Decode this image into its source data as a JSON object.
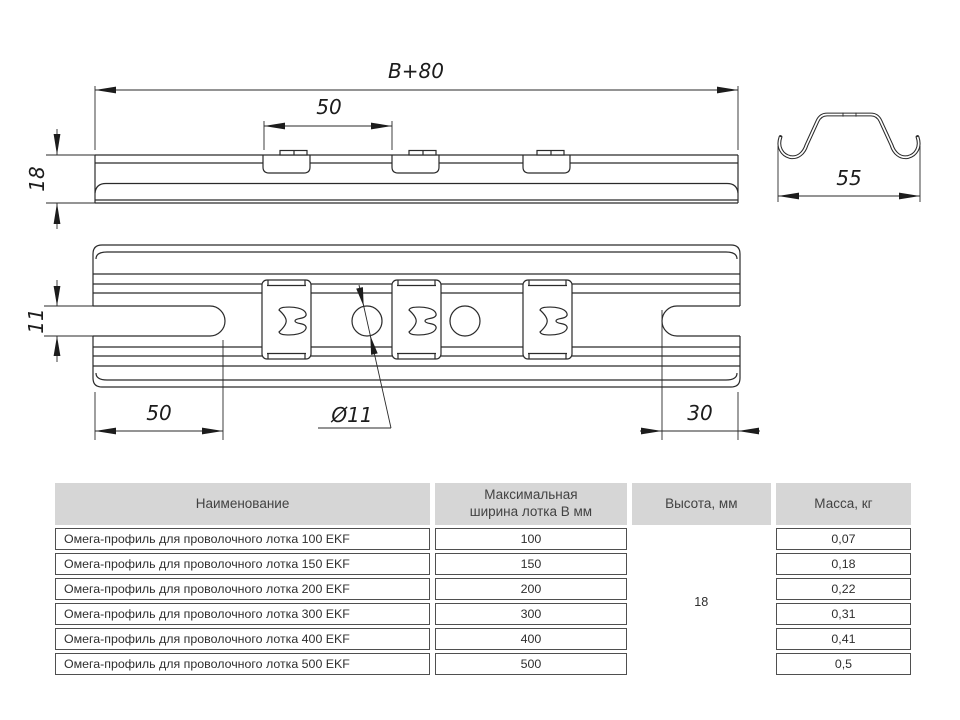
{
  "drawing": {
    "dim_b80": "В+80",
    "dim_50_top": "50",
    "dim_18": "18",
    "dim_55": "55",
    "dim_11": "11",
    "dim_50_bottom": "50",
    "dim_d11": "Ø11",
    "dim_30": "30"
  },
  "table": {
    "headers": {
      "name": "Наименование",
      "width_line1": "Максимальная",
      "width_line2": "ширина лотка В мм",
      "height": "Высота, мм",
      "mass": "Масса, кг"
    },
    "merged_height_value": "18",
    "rows": [
      {
        "name": "Омега-профиль для проволочного лотка 100 EKF",
        "width": "100",
        "mass": "0,07"
      },
      {
        "name": "Омега-профиль для проволочного лотка 150 EKF",
        "width": "150",
        "mass": "0,18"
      },
      {
        "name": "Омега-профиль для проволочного лотка 200 EKF",
        "width": "200",
        "mass": "0,22"
      },
      {
        "name": "Омега-профиль для проволочного лотка 300 EKF",
        "width": "300",
        "mass": "0,31"
      },
      {
        "name": "Омега-профиль для проволочного лотка 400 EKF",
        "width": "400",
        "mass": "0,41"
      },
      {
        "name": "Омега-профиль для проволочного лотка 500 EKF",
        "width": "500",
        "mass": "0,5"
      }
    ]
  },
  "colors": {
    "header_bg": "#d6d6d6",
    "drawing_line": "#2a2a2a",
    "cell_border": "#4f4f4f"
  }
}
